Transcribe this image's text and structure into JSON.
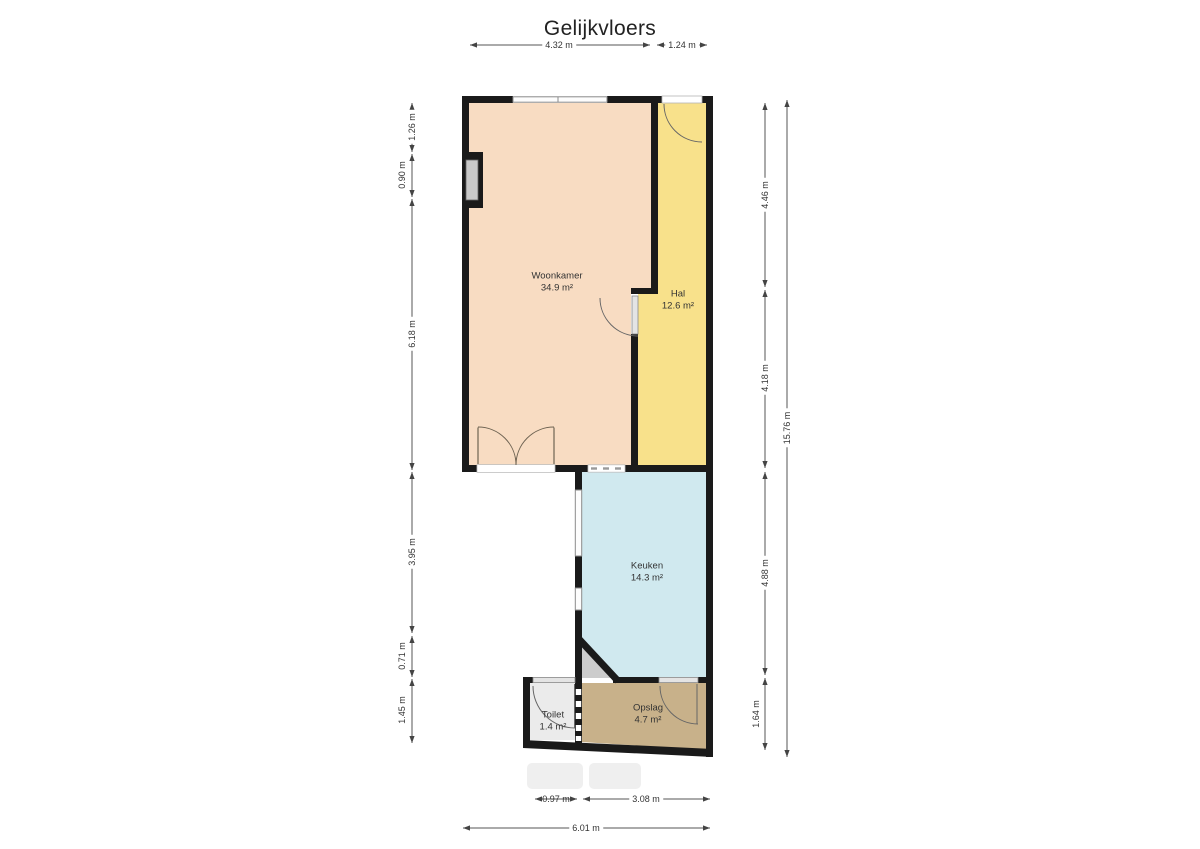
{
  "title": "Gelijkvloers",
  "rooms": {
    "woonkamer": {
      "name": "Woonkamer",
      "area": "34.9 m²"
    },
    "hal": {
      "name": "Hal",
      "area": "12.6 m²"
    },
    "keuken": {
      "name": "Keuken",
      "area": "14.3 m²"
    },
    "toilet": {
      "name": "Toilet",
      "area": "1.4 m²"
    },
    "opslag": {
      "name": "Opslag",
      "area": "4.7 m²"
    }
  },
  "dimensions": {
    "top": [
      "4.32 m",
      "1.24 m"
    ],
    "left": [
      "1.26 m",
      "0.90 m",
      "6.18 m",
      "3.95 m",
      "0.71 m",
      "1.45 m"
    ],
    "right": [
      "4.46 m",
      "4.18 m",
      "4.88 m",
      "1.64 m"
    ],
    "right_total": "15.76 m",
    "bottom": [
      "0.97 m",
      "3.08 m"
    ],
    "bottom_total": "6.01 m"
  },
  "colors": {
    "woonkamer": "#f8dcc2",
    "hal": "#f8e18b",
    "keuken": "#d0e9ef",
    "toilet": "#ebebeb",
    "opslag": "#c8b18a",
    "stairs": "#cccccc",
    "wall": "#1a1a1a"
  }
}
